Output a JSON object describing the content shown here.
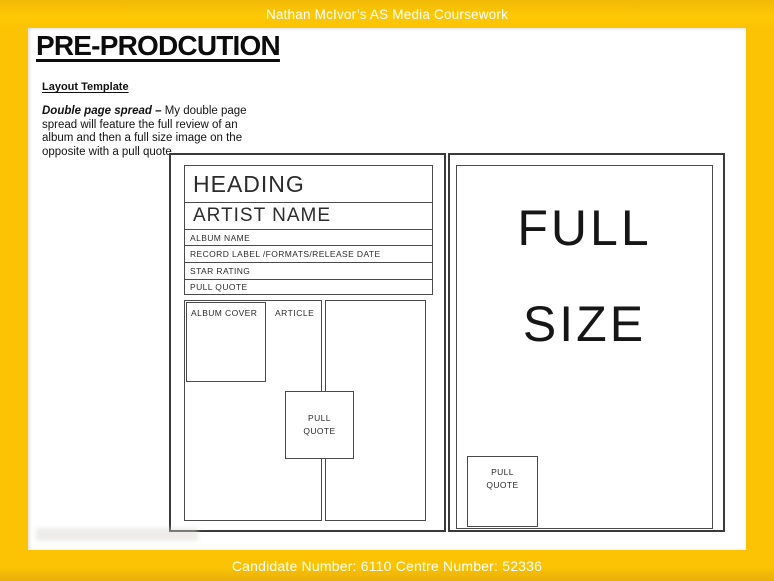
{
  "frame": {
    "header_text": "Nathan McIvor’s AS Media Coursework",
    "footer_text": "Candidate Number: 6110 Centre Number: 52336",
    "accent_yellow": "#fbc303",
    "accent_yellow_dark": "#e9ae0c"
  },
  "slide": {
    "title": "PRE-PRODCUTION",
    "subtitle": "Layout Template",
    "paragraph": {
      "lead": "Double page spread –",
      "line1_rest": " My double page",
      "lines_rest": "spread will feature the full review of an\nalbum and then a full size image on the\nopposite with a pull quote."
    }
  },
  "left_page": {
    "rows": [
      "HEADING",
      "ARTIST NAME",
      "ALBUM NAME",
      "RECORD LABEL /FORMATS/RELEASE DATE",
      "STAR RATING",
      "PULL QUOTE"
    ],
    "album_cover_label": "ALBUM COVER",
    "article_label": "ARTICLE",
    "pull_quote": "PULL\nQUOTE"
  },
  "right_page": {
    "full_size": "FULL\nSIZE",
    "pull_quote": "PULL\nQUOTE"
  }
}
